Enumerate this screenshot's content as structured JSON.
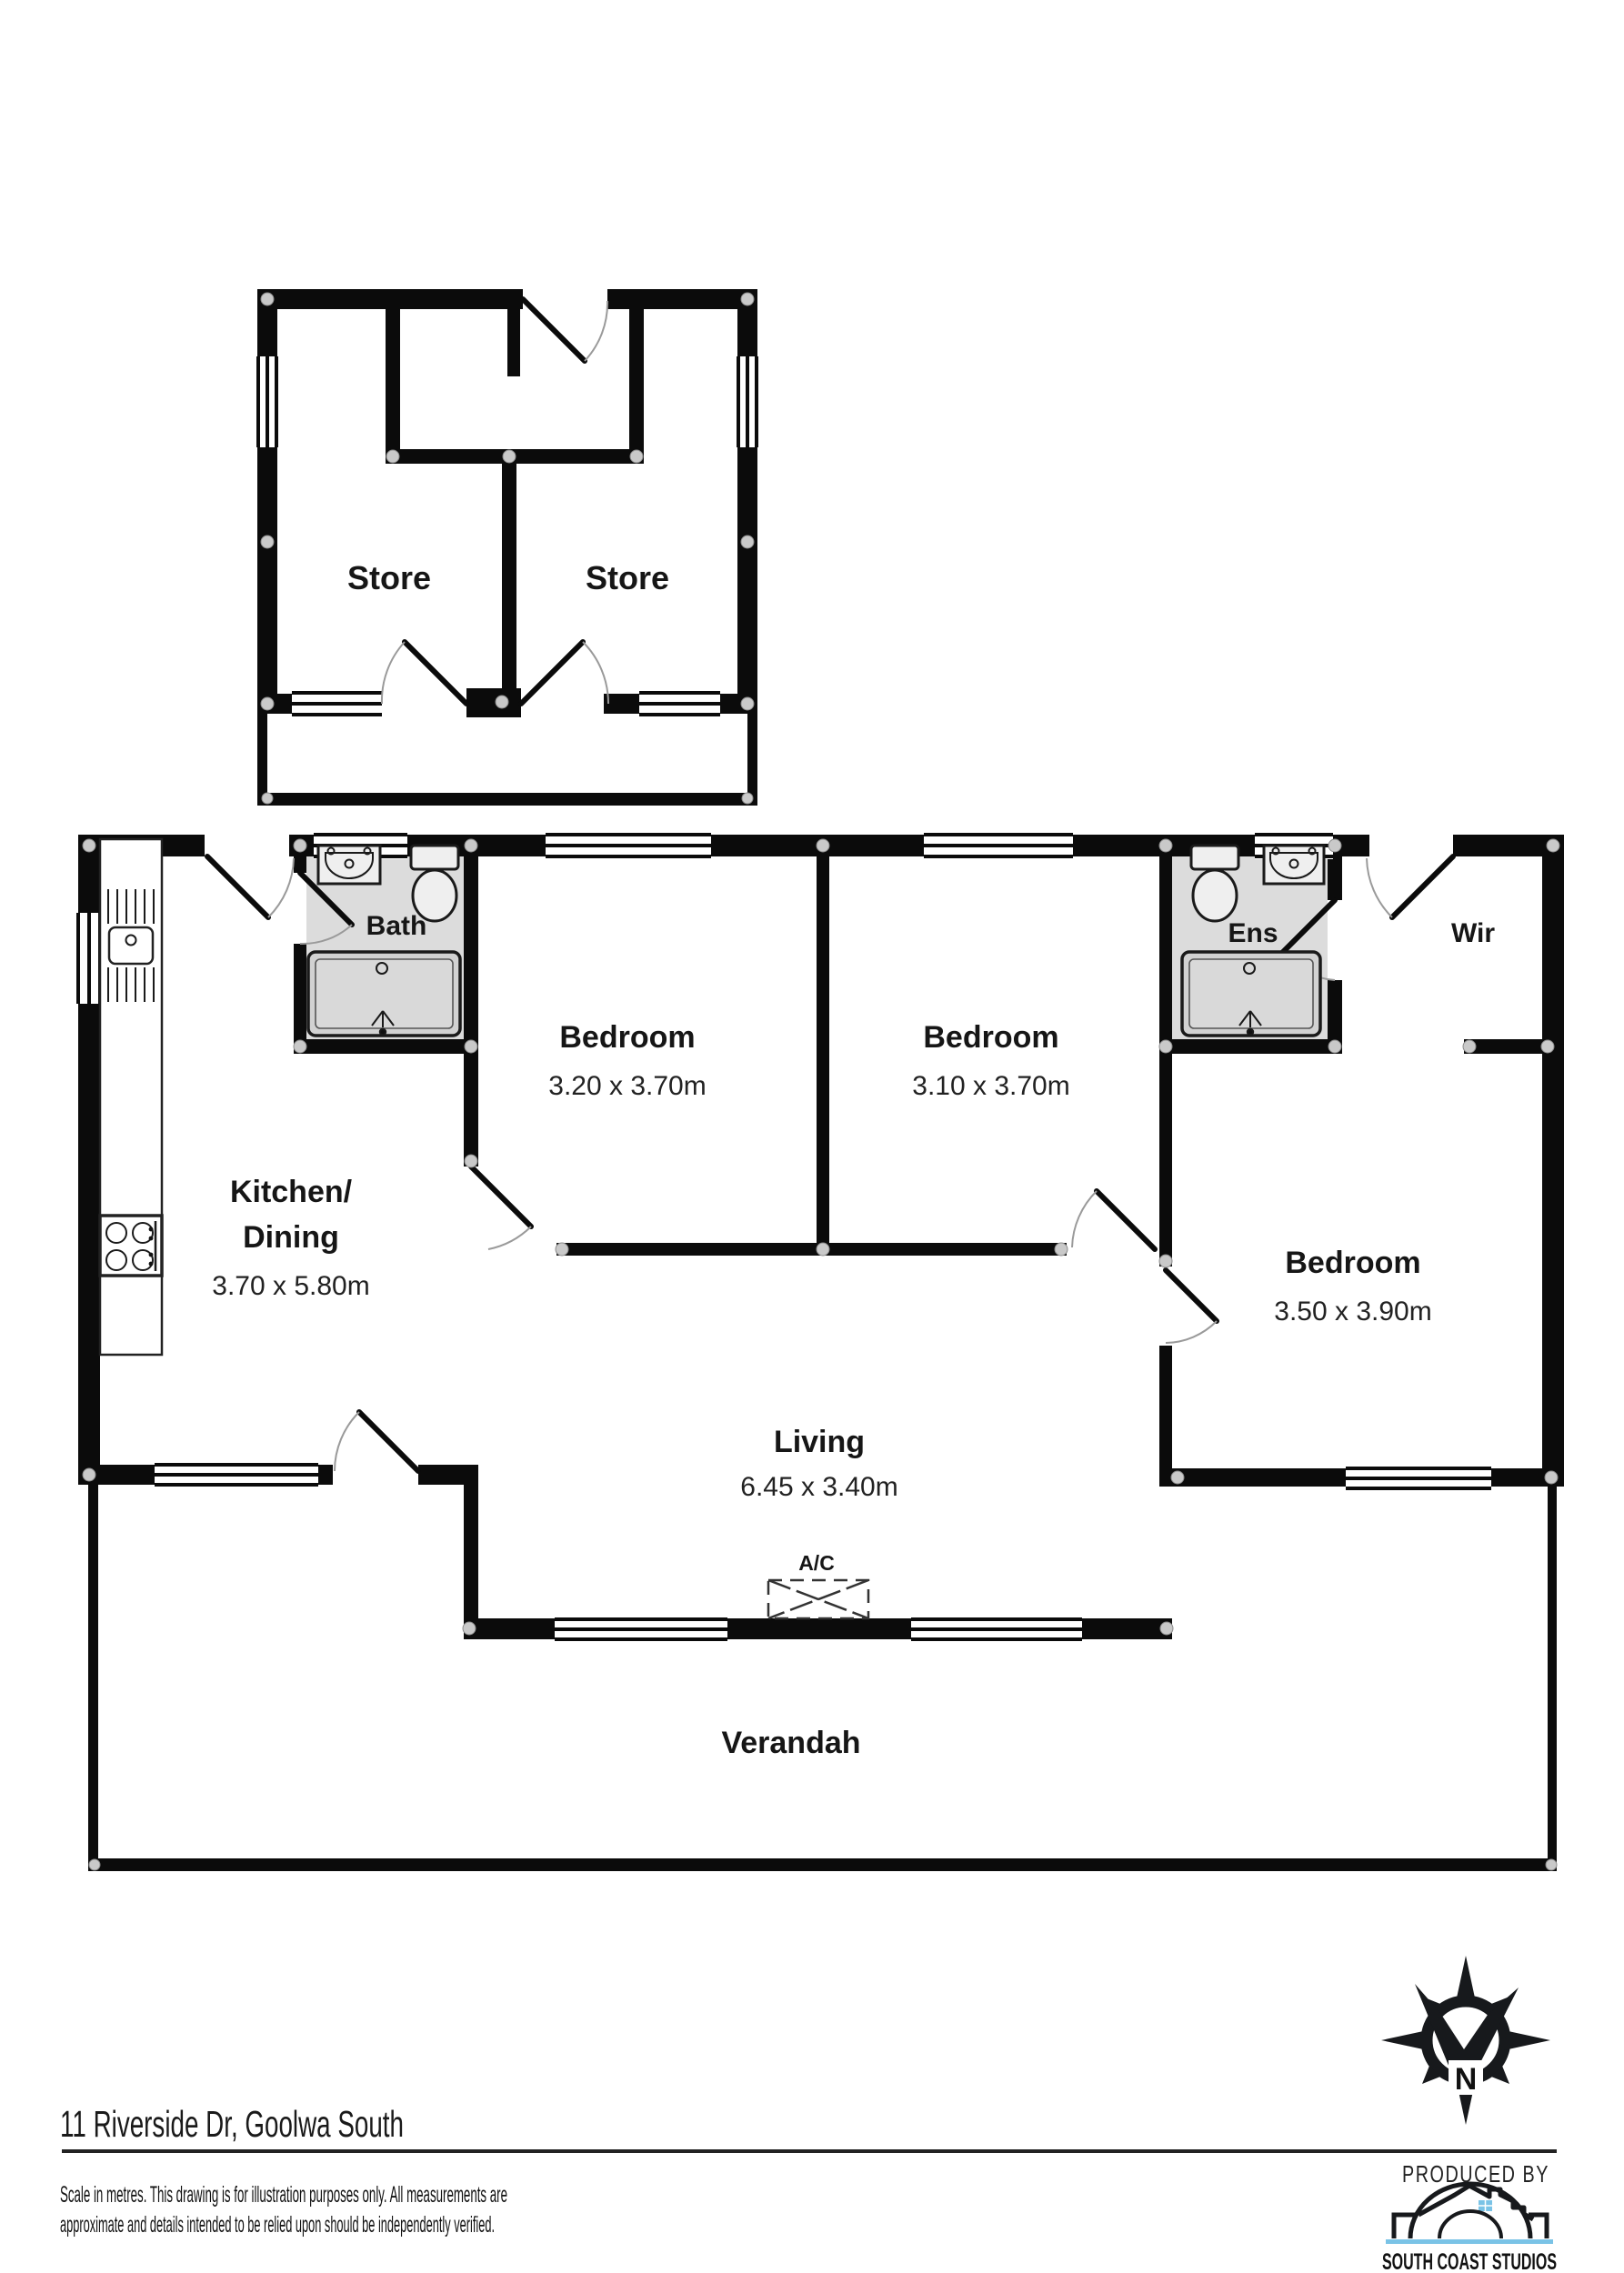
{
  "colors": {
    "wall": "#0b0b0b",
    "bath_floor": "#dcdcdc",
    "fixture_fill": "#efefef",
    "tray_fill": "#d2d2d2",
    "corner_dot": "#c9c9c9",
    "accent_blue": "#7ac3e6",
    "text": "#1a1a1a"
  },
  "store_building": {
    "store_left_label": "Store",
    "store_right_label": "Store"
  },
  "main_house": {
    "bath_label": "Bath",
    "ens_label": "Ens",
    "wir_label": "Wir",
    "bedroom1": {
      "name": "Bedroom",
      "dims": "3.20 x 3.70m"
    },
    "bedroom2": {
      "name": "Bedroom",
      "dims": "3.10 x 3.70m"
    },
    "bedroom3": {
      "name": "Bedroom",
      "dims": "3.50 x 3.90m"
    },
    "kitchen": {
      "name_line1": "Kitchen/",
      "name_line2": "Dining",
      "dims": "3.70 x 5.80m"
    },
    "living": {
      "name": "Living",
      "dims": "6.45 x 3.40m"
    },
    "ac_label": "A/C",
    "verandah_label": "Verandah"
  },
  "footer": {
    "address": "11 Riverside Dr, Goolwa South",
    "disclaimer_line1": "Scale in metres. This drawing is for illustration purposes only. All measurements are",
    "disclaimer_line2": "approximate and details intended to be relied upon should be independently verified.",
    "produced_by": "PRODUCED BY",
    "studio_name": "SOUTH COAST STUDIOS"
  },
  "compass": {
    "north_label": "N"
  }
}
